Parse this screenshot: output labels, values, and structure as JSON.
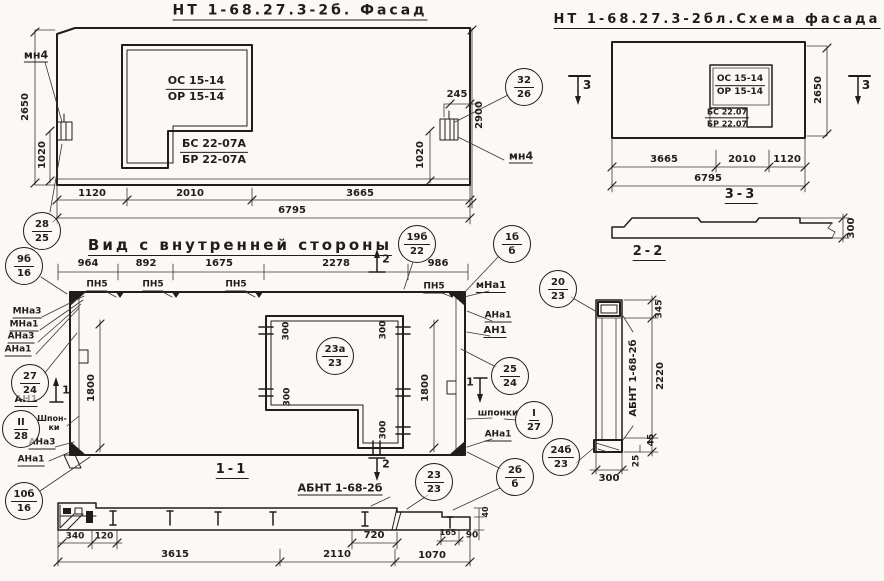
{
  "palette": {
    "ink": "#211e19",
    "paper": "#faf9f5"
  },
  "facade": {
    "title": "НТ 1-68.27.3-2б. Фасад",
    "window_mark_top": {
      "top": "ОС 15-14",
      "bottom": "ОР 15-14"
    },
    "window_mark_bottom": {
      "top": "БС 22-07А",
      "bottom": "БР 22-07А"
    },
    "anchor_label": "мн4",
    "callout_32": {
      "top": "32",
      "bottom": "26"
    },
    "callout_28": {
      "top": "28",
      "bottom": "25"
    },
    "dim_height_left": "2650",
    "dim_height_right": "2900",
    "dim_anchor_left": "1020",
    "dim_anchor_right": "1020",
    "dim_245": "245",
    "dims_bottom": [
      "1120",
      "2010",
      "3665"
    ],
    "dim_total": "6795"
  },
  "schema": {
    "title": "НТ 1-68.27.3-2бл.Схема фасада",
    "window_mark_top": {
      "top": "ОС 15-14",
      "bottom": "ОР 15-14"
    },
    "window_mark_bottom": {
      "top": "БС 22.07",
      "bottom": "БР 22.07"
    },
    "dim_height": "2650",
    "dims_bottom": [
      "3665",
      "2010",
      "1120"
    ],
    "dim_total": "6795",
    "section_mark": "3"
  },
  "section33": {
    "title": "3-3",
    "dim_thickness": "300"
  },
  "inner": {
    "title": "Вид с внутренней стороны",
    "dims_top": [
      "964",
      "892",
      "1675",
      "2278",
      "986"
    ],
    "pn_label": "ПН5",
    "section_mark_2": "2",
    "section_mark_1": "1",
    "dim_1800": "1800",
    "dim_300": "300",
    "labels": {
      "mna3": "МНа3",
      "mna1": "МНа1",
      "ana3": "АНа3",
      "ana1": "АНа1",
      "an1": "АН1",
      "mna1_r": "мНа1",
      "shponki": "шпонки",
      "shpon_1": "Шпон-",
      "shpon_2": "ки"
    },
    "callouts": {
      "c9b16": {
        "top": "9б",
        "bottom": "16"
      },
      "c19b22": {
        "top": "19б",
        "bottom": "22"
      },
      "c1bb": {
        "top": "1б",
        "bottom": "б"
      },
      "c27_24": {
        "top": "27",
        "bottom": "24"
      },
      "cII28": {
        "top": "II",
        "bottom": "28"
      },
      "c25_24": {
        "top": "25",
        "bottom": "24"
      },
      "cI27": {
        "top": "I",
        "bottom": "27"
      },
      "c10b16": {
        "top": "10б",
        "bottom": "16"
      },
      "c23a23": {
        "top": "23а",
        "bottom": "23"
      }
    }
  },
  "section22": {
    "title": "2-2",
    "panel_mark": "АБНТ 1-68-2б",
    "callout_20": {
      "top": "20",
      "bottom": "23"
    },
    "callout_24b": {
      "top": "24б",
      "bottom": "23"
    },
    "dims": {
      "d345": "345",
      "d2220": "2220",
      "d45": "45",
      "d25": "25",
      "d300": "300"
    }
  },
  "section11": {
    "title": "1-1",
    "panel_mark": "АБНТ 1-68-2б",
    "callout_23": {
      "top": "23",
      "bottom": "23"
    },
    "callout_2b": {
      "top": "2б",
      "bottom": "б"
    },
    "dims_row1": [
      "340",
      "120",
      "720",
      "165"
    ],
    "dims_row2": [
      "3615",
      "2110",
      "1070"
    ],
    "dim_40": "40",
    "dim_90": "90"
  }
}
